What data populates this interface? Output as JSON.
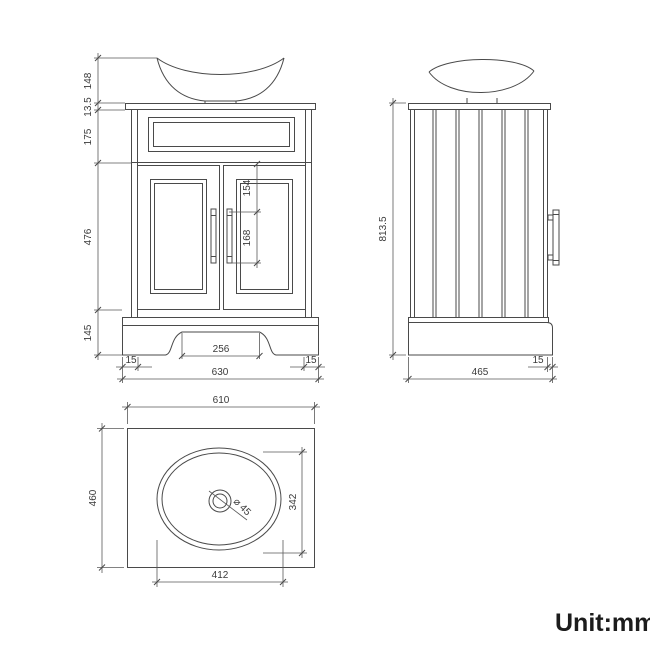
{
  "unit_label": "Unit:mm",
  "front_view": {
    "basin_height": "148",
    "worktop_thickness": "13.5",
    "top_panel_height": "175",
    "door_height": "476",
    "plinth_height": "145",
    "handle_top_offset": "154",
    "handle_length": "168",
    "plinth_arch_width": "256",
    "plinth_inset_left": "15",
    "plinth_inset_right": "15",
    "overall_width": "630"
  },
  "side_view": {
    "overall_height": "813.5",
    "overall_depth": "465",
    "plinth_inset": "15"
  },
  "top_view": {
    "worktop_width": "610",
    "worktop_depth": "460",
    "basin_length": "412",
    "basin_depth": "342",
    "drain_diameter": "⌀ 45"
  },
  "colors": {
    "line": "#4a4a4a",
    "dimension_line": "#5a5a5a",
    "text": "#3a3a3a",
    "unit_text": "#1c1c1c",
    "background": "#ffffff"
  }
}
